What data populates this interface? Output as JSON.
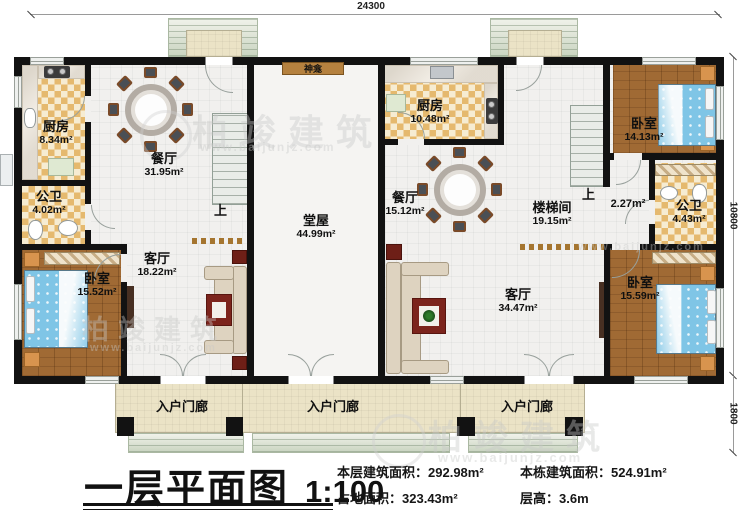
{
  "plan": {
    "dimensions": {
      "top_width": "24300",
      "right_height": "10800",
      "porch_depth": "1800"
    },
    "labels": {
      "up": "上",
      "shrine": "神龛"
    },
    "rooms": [
      {
        "name": "厨房",
        "area": "8.34m²"
      },
      {
        "name": "餐厅",
        "area": "31.95m²"
      },
      {
        "name": "公卫",
        "area": "4.02m²"
      },
      {
        "name": "卧室",
        "area": "15.52m²"
      },
      {
        "name": "客厅",
        "area": "18.22m²"
      },
      {
        "name": "堂屋",
        "area": "44.99m²"
      },
      {
        "name": "厨房",
        "area": "10.48m²"
      },
      {
        "name": "餐厅",
        "area": "15.12m²"
      },
      {
        "name": "楼梯间",
        "area": "19.15m²"
      },
      {
        "name": "",
        "area": "2.27m²"
      },
      {
        "name": "卧室",
        "area": "14.13m²"
      },
      {
        "name": "公卫",
        "area": "4.43m²"
      },
      {
        "name": "客厅",
        "area": "34.47m²"
      },
      {
        "name": "卧室",
        "area": "15.59m²"
      }
    ],
    "porches": [
      {
        "name": "入户门廊"
      },
      {
        "name": "入户门廊"
      },
      {
        "name": "入户门廊"
      }
    ]
  },
  "title_block": {
    "plan_name": "一层平面图",
    "scale": "1:100",
    "stats": [
      {
        "label": "本层建筑面积：",
        "value": "292.98m²"
      },
      {
        "label": "本栋建筑面积：",
        "value": "524.91m²"
      },
      {
        "label": "占地面积：",
        "value": "323.43m²"
      },
      {
        "label": "层高：",
        "value": "3.6m"
      }
    ]
  },
  "watermark": {
    "brand": "柏竣建筑",
    "url": "www.baijunjz.com"
  },
  "colors": {
    "wall": "#121212",
    "wood_floor": "#a06a34",
    "tile": "#e5b96e",
    "bed": "#7fc5e6",
    "porch": "#ebe3c6",
    "shrine": "#b5813f"
  }
}
